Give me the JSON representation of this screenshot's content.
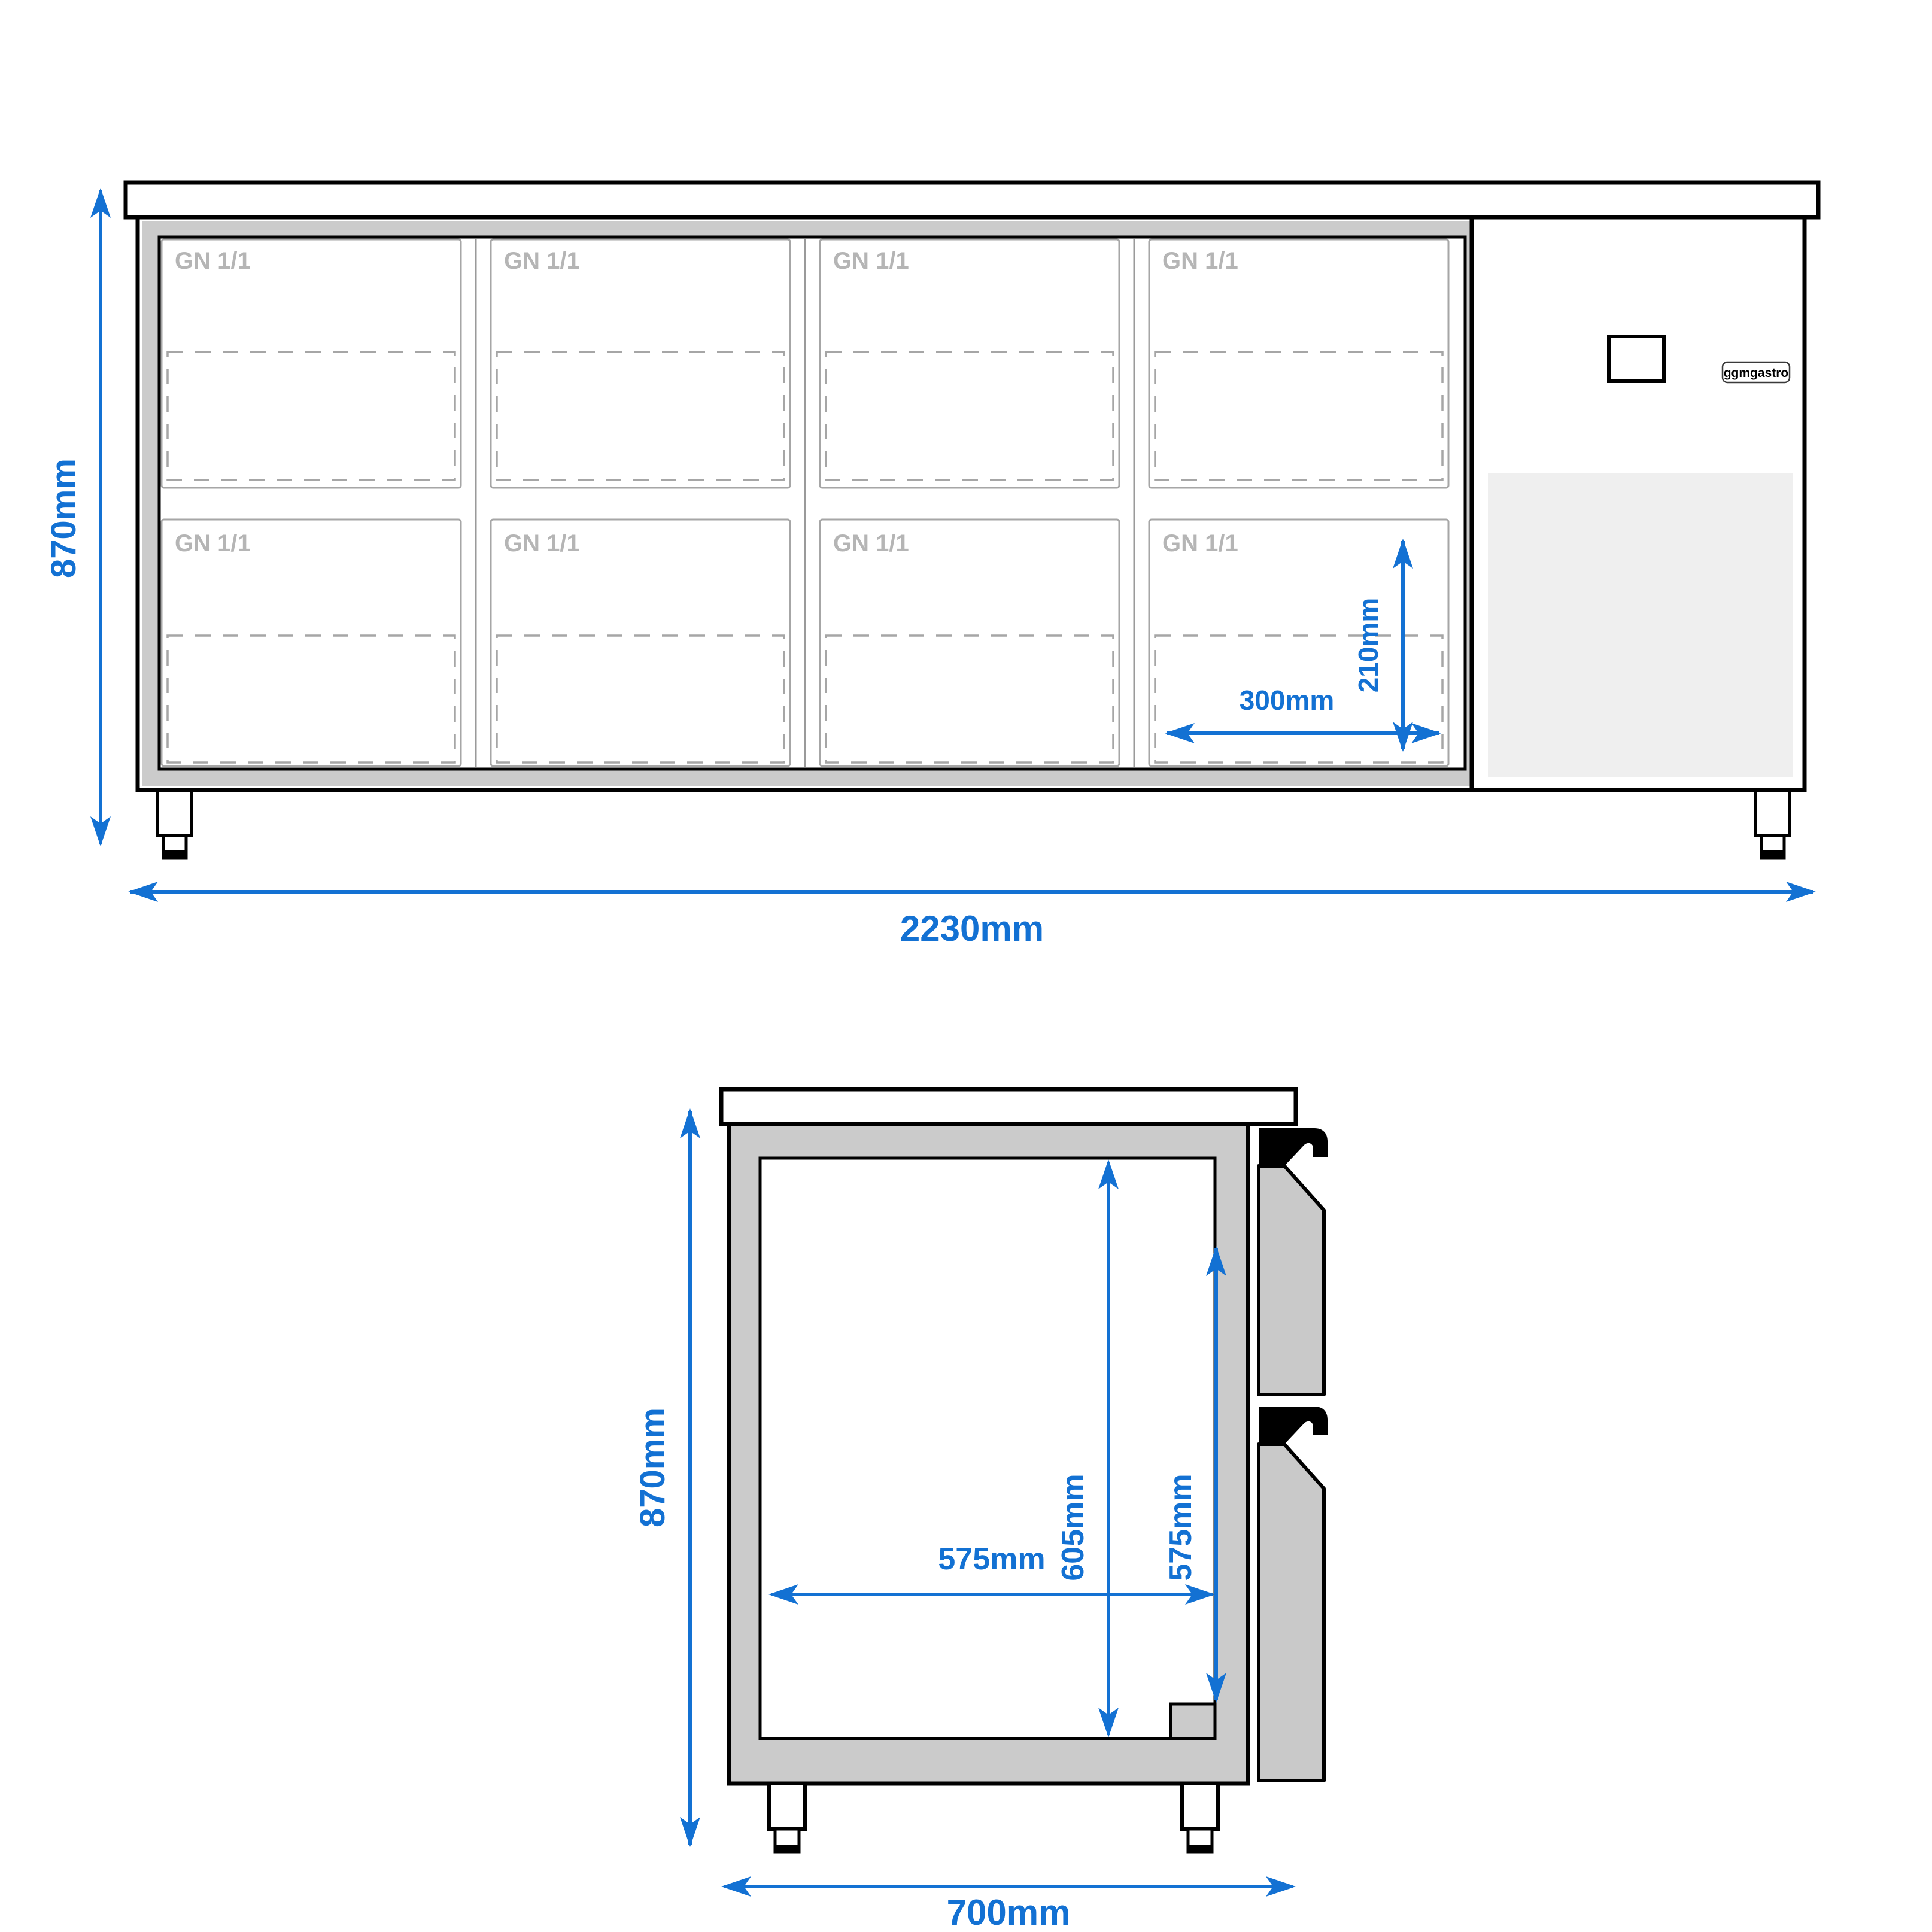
{
  "brand": {
    "label": "ggmgastro"
  },
  "colors": {
    "dimension_blue": "#1371d3",
    "outline_black": "#000000",
    "liner_gray": "#cbcbcb",
    "drawer_gray": "#c9c9c9",
    "box_border_gray": "#a6a6a6",
    "door_line_gray": "#9a9a9a",
    "gn_text_gray": "#b5b5b5",
    "condenser_gray": "#efefef",
    "badge_border": "#3a3a3a"
  },
  "front_view": {
    "height_dim": "870mm",
    "width_dim": "2230mm",
    "pan_width_dim": "300mm",
    "pan_height_dim": "210mm",
    "compartments": [
      {
        "label": "GN 1/1"
      },
      {
        "label": "GN 1/1"
      },
      {
        "label": "GN 1/1"
      },
      {
        "label": "GN 1/1"
      },
      {
        "label": "GN 1/1"
      },
      {
        "label": "GN 1/1"
      },
      {
        "label": "GN 1/1"
      },
      {
        "label": "GN 1/1"
      }
    ]
  },
  "side_view": {
    "height_dim": "870mm",
    "depth_dim": "700mm",
    "inner_height_dim": "605mm",
    "drawer_height_dim": "575mm",
    "inner_depth_dim": "575mm"
  }
}
